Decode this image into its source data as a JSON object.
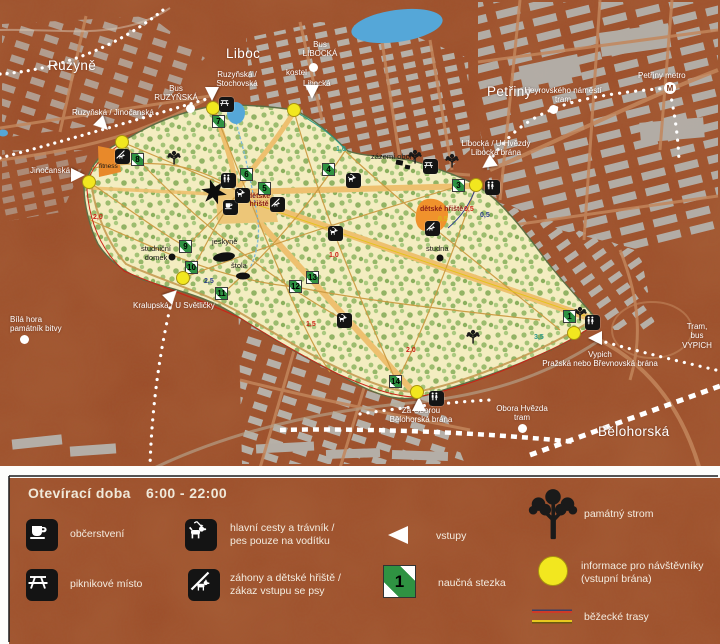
{
  "map": {
    "districts": {
      "ruzyne": "Ruzyně",
      "liboc": "Liboc",
      "petriny": "Petřiny",
      "belohorska": "Bělohorská"
    },
    "transit": {
      "bus_libocka": "Bus\nLIBOCKÁ",
      "kostel": "kostel",
      "bus_ruzynska": "Bus\nRUZYŇSKÁ",
      "heyrovskeho": "Heyrovského náměstí\ntram",
      "petriny_metro": "Petřiny metro",
      "obora_hvezda_tram": "Obora Hvězda\ntram",
      "tram_bus_vypich": "Tram, bus\nVYPICH",
      "bila_hora": "Bílá hora\npamátník bitvy"
    },
    "entrances": {
      "ruzynska_stochovska": "Ruzyňská /\nStochovská",
      "ruzynska_jinocanska": "Ruzyňská / Jinočanská",
      "jinocanska": "Jinočanská",
      "libocka": "Libocká",
      "libocka_u_hvezdy": "Libocká / U Hvězdy\nLibocká brána",
      "kralupska": "Kralupská / U Světličky",
      "za_oborou": "Za Oborou\nBělohorská brána",
      "vypich": "Vypich\nPražská nebo Břevnovská brána"
    },
    "pois": {
      "fitness": "fitness",
      "zazemi_obory": "zázemí obory",
      "detske_hriste_west": "dětské\nhřiště",
      "detske_hriste_east": "dětské hřiště",
      "studna": "studna",
      "jeskyne": "jeskyně",
      "studnicni_domek": "studniční\ndomek",
      "stola": "štola"
    },
    "distances": [
      "1,0",
      "1,0",
      "0,5",
      "0,5",
      "0,5",
      "1,5",
      "2,0",
      "2,0",
      "2,5",
      "3,5"
    ],
    "trail_numbers": [
      "1",
      "3",
      "4",
      "5",
      "6",
      "7",
      "8",
      "9",
      "10",
      "11",
      "12",
      "13",
      "14"
    ]
  },
  "legend": {
    "title": "Otevírací doba",
    "hours": "6:00 - 22:00",
    "stezka_number": "1",
    "items": {
      "obcerstveni": "občerstvení",
      "piknikove_misto": "piknikové místo",
      "hlavni_cesty": "hlavní cesty a trávník /\npes pouze na vodítku",
      "zahony": "záhony a dětské hřiště /\nzákaz vstupu se psy",
      "vstupy": "vstupy",
      "naucna_stezka": "naučná stezka",
      "pamatny_strom": "památný strom",
      "informace": "informace pro návštěvníky\n(vstupní brána)",
      "bezecke_trasy": "běžecké trasy"
    }
  },
  "colors": {
    "urban_brown": "#9c4c28",
    "park_cream": "#f3edc0",
    "tree_green": "#9cbc6e",
    "path_orange": "#eec06f",
    "info_yellow": "#f2e71f",
    "trail_green": "#2f9242",
    "water_blue": "#55a7d8"
  }
}
